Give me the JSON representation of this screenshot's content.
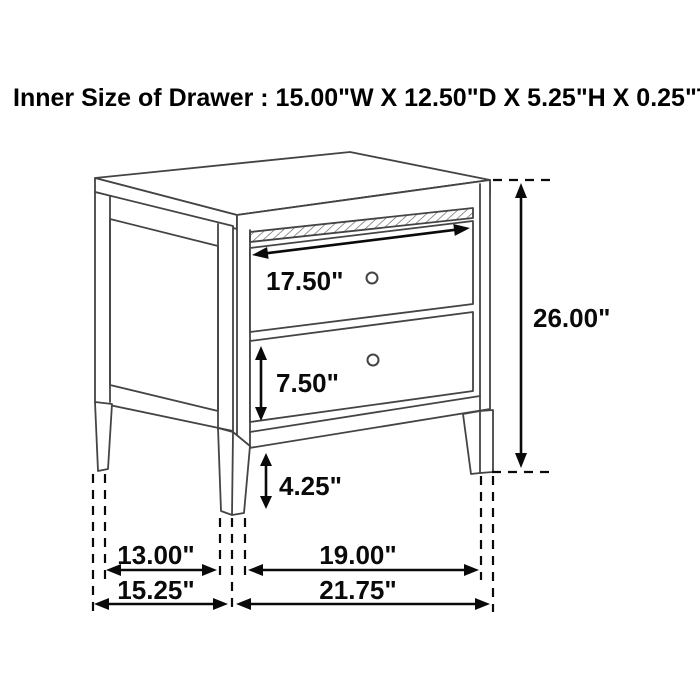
{
  "title": "Inner Size of Drawer : 15.00\"W X 12.50\"D X 5.25\"H X 0.25\"T",
  "colors": {
    "background": "#ffffff",
    "furniture_line": "#444444",
    "dimension_line": "#0a0a0a"
  },
  "furniture": {
    "item": "two-drawer nightstand",
    "drawer_count": 2,
    "knob_count": 2
  },
  "labels": {
    "drawer_width": "17.50\"",
    "overall_height": "26.00\"",
    "drawer_height": "7.50\"",
    "leg_height": "4.25\"",
    "leg_span_depth": "13.00\"",
    "leg_span_width": "19.00\"",
    "overall_depth": "15.25\"",
    "overall_width": "21.75\""
  }
}
